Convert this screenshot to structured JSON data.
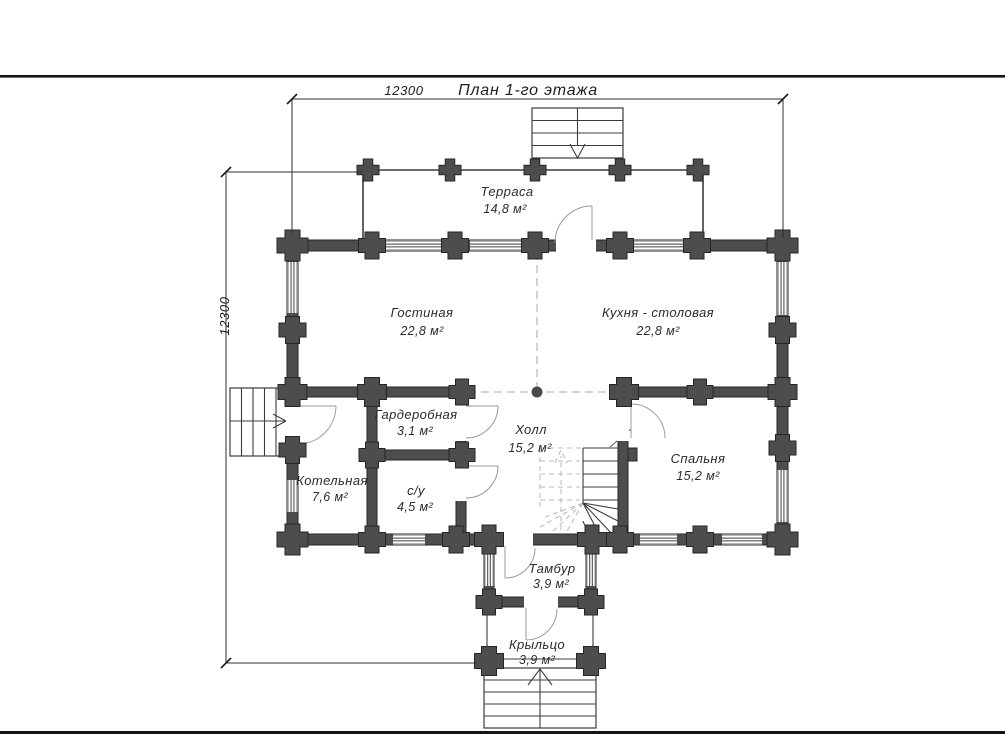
{
  "title": "План 1-го этажа",
  "dimensions": {
    "width_mm": "12300",
    "height_mm": "12300"
  },
  "rooms": {
    "terrace": {
      "name": "Терраса",
      "area": "14,8 м²"
    },
    "living": {
      "name": "Гостиная",
      "area": "22,8 м²"
    },
    "kitchen": {
      "name": "Кухня - столовая",
      "area": "22,8 м²"
    },
    "wardrobe": {
      "name": "Гардеробная",
      "area": "3,1 м²"
    },
    "hall": {
      "name": "Холл",
      "area": "15,2 м²"
    },
    "boiler": {
      "name": "Котельная",
      "area": "7,6 м²"
    },
    "wc": {
      "name": "с/у",
      "area": "4,5 м²"
    },
    "bedroom": {
      "name": "Спальня",
      "area": "15,2 м²"
    },
    "vestibule": {
      "name": "Тамбур",
      "area": "3,9 м²"
    },
    "porch": {
      "name": "Крыльцо",
      "area": "3,9 м²"
    }
  },
  "colors": {
    "wall": "#4d4d4d",
    "wall_outline": "#262626",
    "thin_line": "#3c3c3c",
    "dashed": "#bcbcbc",
    "arc": "#9a9a9a",
    "text": "#2b2b2b",
    "border": "#151515"
  }
}
